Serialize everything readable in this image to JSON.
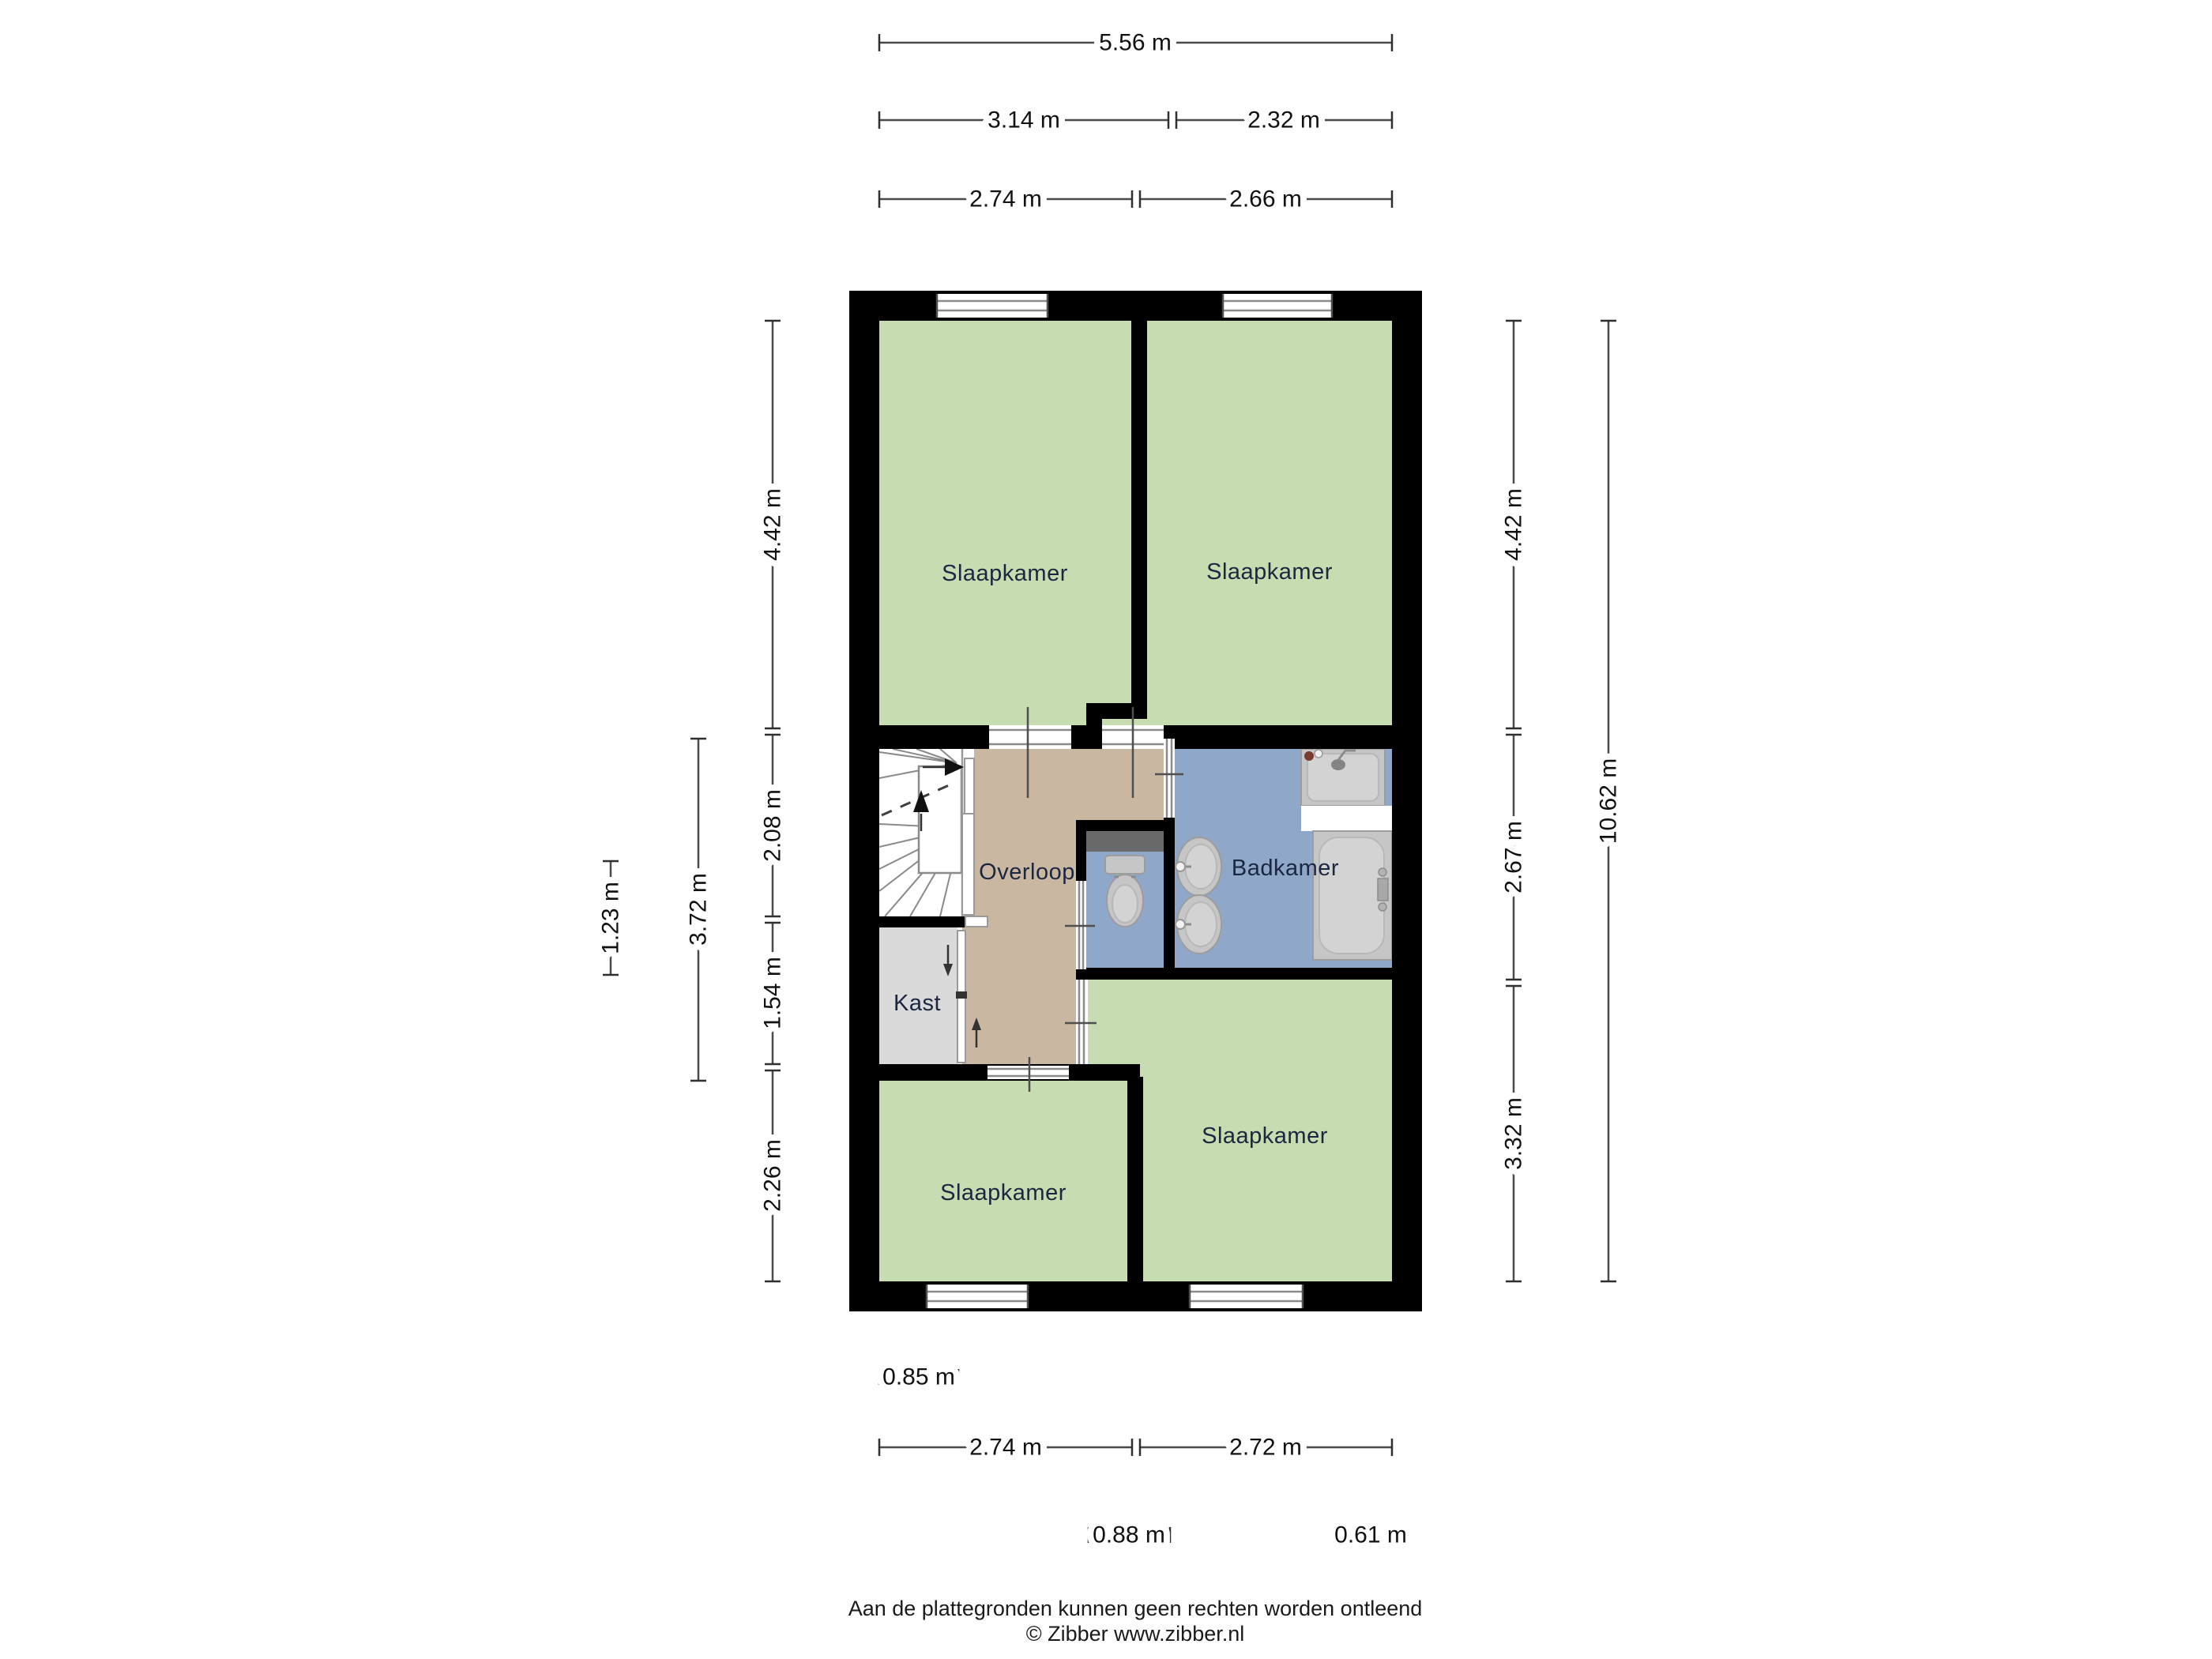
{
  "colors": {
    "wall": "#000000",
    "bedroom_fill": "#c7dcb0",
    "landing_fill": "#c9b7a2",
    "bathroom_fill": "#8fa7c9",
    "toilet_fill": "#8fa7c9",
    "closet_fill": "#dadada",
    "shelf_fill": "#696969",
    "room_label": "#1b2740",
    "dim_text": "#111111"
  },
  "rooms": {
    "bedroom_top_left": {
      "label": "Slaapkamer"
    },
    "bedroom_top_right": {
      "label": "Slaapkamer"
    },
    "landing": {
      "label": "Overloop"
    },
    "bathroom": {
      "label": "Badkamer"
    },
    "closet": {
      "label": "Kast"
    },
    "bedroom_bottom_left": {
      "label": "Slaapkamer"
    },
    "bedroom_bottom_right": {
      "label": "Slaapkamer"
    }
  },
  "dimensions": {
    "top": [
      "5.56 m",
      "3.14 m",
      "2.32 m",
      "2.74 m",
      "2.66 m"
    ],
    "left": [
      "4.42 m",
      "2.08 m",
      "1.54 m",
      "2.26 m",
      "3.72 m",
      "1.23 m"
    ],
    "right": [
      "4.42 m",
      "2.67 m",
      "3.32 m",
      "10.62 m"
    ],
    "bottom": [
      "0.85 m",
      "2.74 m",
      "2.72 m",
      "0.88 m",
      "0.61 m"
    ]
  },
  "footer": {
    "line1": "Aan de plattegronden kunnen geen rechten worden ontleend",
    "line2": "© Zibber www.zibber.nl"
  }
}
